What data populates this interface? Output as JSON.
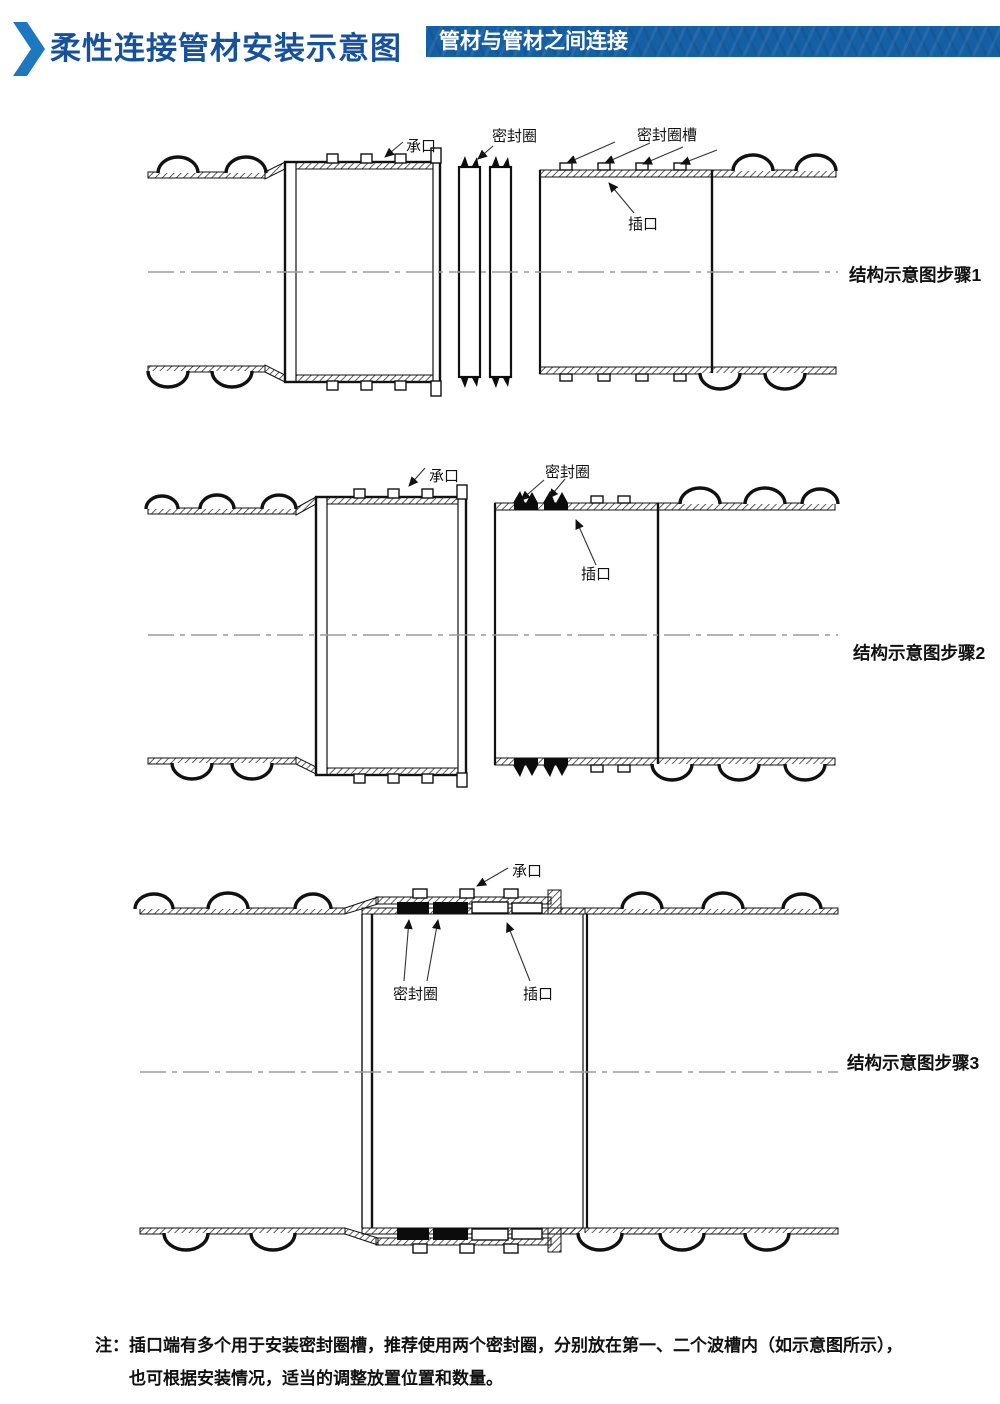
{
  "header": {
    "icon": "chevron-right-icon",
    "title": "柔性连接管材安装示意图",
    "banner": "管材与管材之间连接",
    "colors": {
      "title": "#17519b",
      "banner_bg": "#155fa5",
      "banner_text": "#ffffff",
      "chevron": "#1e78c0",
      "drawing_line": "#111111",
      "centerline": "#9a9a9a"
    }
  },
  "diagrams": [
    {
      "caption": "结构示意图步骤1",
      "labels": {
        "socket": "承口",
        "seal_ring": "密封圈",
        "seal_ring_groove": "密封圈槽",
        "spigot": "插口"
      }
    },
    {
      "caption": "结构示意图步骤2",
      "labels": {
        "socket": "承口",
        "seal_ring": "密封圈",
        "spigot": "插口"
      }
    },
    {
      "caption": "结构示意图步骤3",
      "labels": {
        "socket": "承口",
        "seal_ring": "密封圈",
        "spigot": "插口"
      }
    }
  ],
  "note": {
    "prefix": "注：",
    "lines": [
      "插口端有多个用于安装密封圈槽，推荐使用两个密封圈，分别放在第一、二个波槽内（如示意图所示），",
      "也可根据安装情况，适当的调整放置位置和数量。"
    ]
  }
}
